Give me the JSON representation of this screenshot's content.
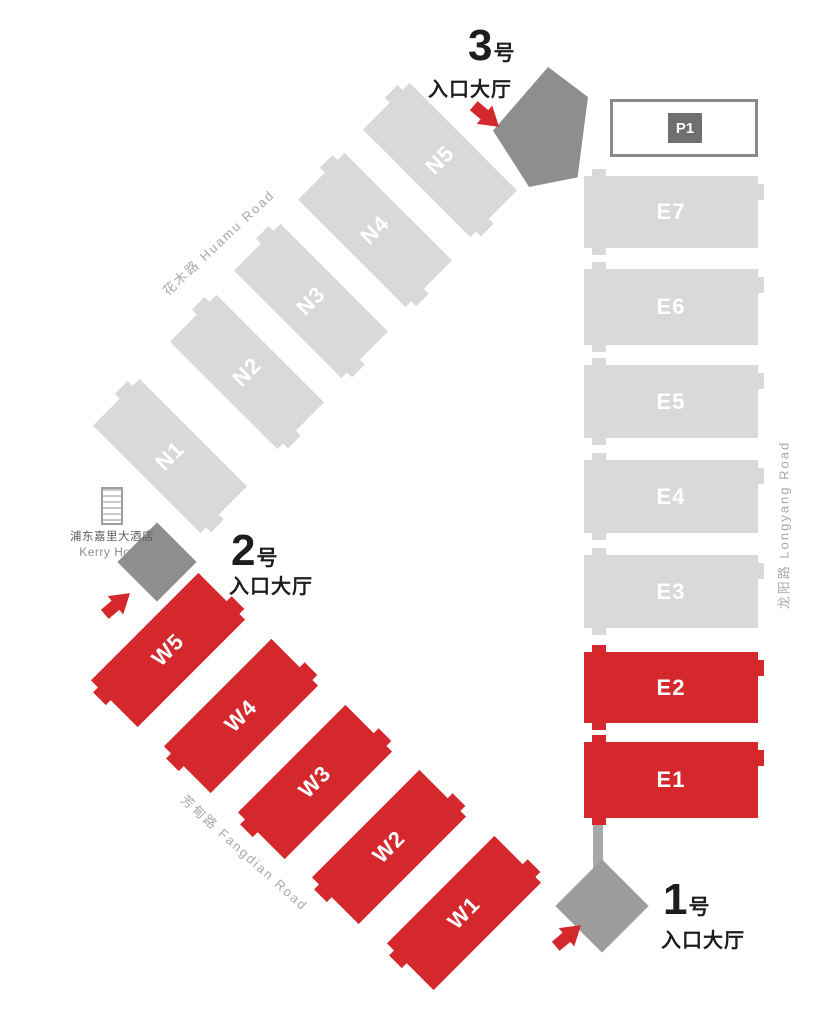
{
  "halls": {
    "north": [
      "N1",
      "N2",
      "N3",
      "N4",
      "N5"
    ],
    "west": [
      "W5",
      "W4",
      "W3",
      "W2",
      "W1"
    ],
    "east": [
      "E7",
      "E6",
      "E5",
      "E4",
      "E3",
      "E2",
      "E1"
    ]
  },
  "entrances": {
    "e3": {
      "number": "3",
      "unit": "号",
      "label": "入口大厅"
    },
    "e2": {
      "number": "2",
      "unit": "号",
      "label": "入口大厅"
    },
    "e1": {
      "number": "1",
      "unit": "号",
      "label": "入口大厅"
    }
  },
  "parking": {
    "label": "P1"
  },
  "hotel": {
    "name_cn": "浦东嘉里大酒店",
    "name_en": "Kerry Hotel"
  },
  "roads": {
    "huamu": "花木路  Huamu Road",
    "fangdian": "芳甸路  Fangdian Road",
    "longyang": "龙阳路  Longyang Road"
  },
  "colors": {
    "highlight_red": "#d4282c",
    "hall_gray": "#d9d9da",
    "lobby_gray": "#8e8e8e",
    "lobby_light_gray": "#9c9c9c",
    "road_text_gray": "#a9a9a9",
    "text_black": "#1d1d1d",
    "parking_badge_gray": "#6f6f6f"
  }
}
